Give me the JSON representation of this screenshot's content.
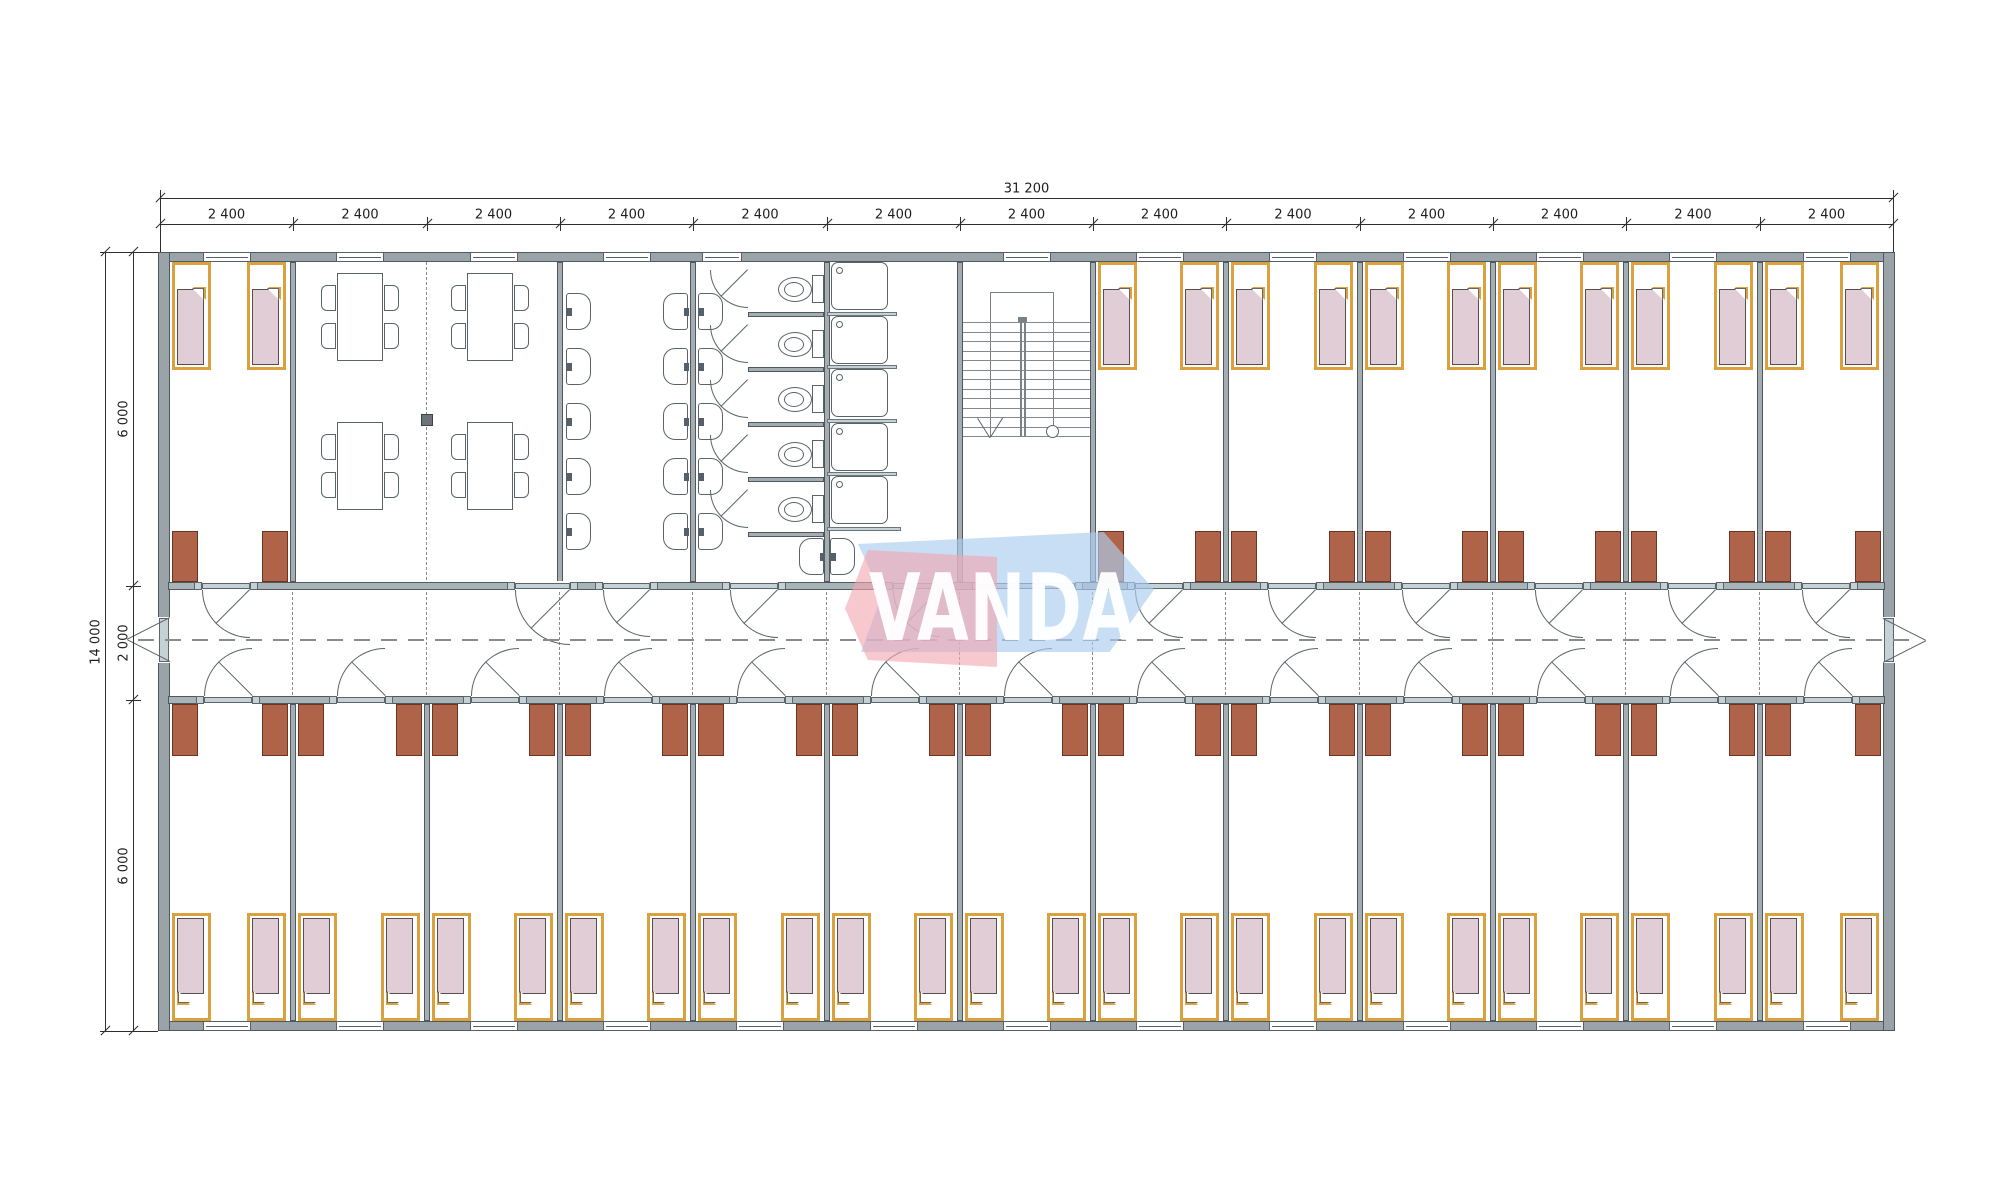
{
  "drawing": {
    "logo": {
      "text": "VANDA",
      "pink": "rgba(242,166,176,0.62)",
      "blue": "rgba(171,205,238,0.66)"
    },
    "dimensions": {
      "top_total_label": "31 200",
      "module_label": "2 400",
      "module_count": 13,
      "left_total_label": "14 000",
      "left_segment_labels": [
        "6 000",
        "2 000",
        "6 000"
      ]
    },
    "colors": {
      "outerWall": "#99a3a8",
      "wallStroke": "#4e585e",
      "innerWall": "#a3adb2",
      "corridorWall": "#a9b4b9",
      "sill": "#c6d1d6",
      "bedFrame": "#dca13f",
      "mattress": "#e0cdd5",
      "wardrobe": "#af6348",
      "wardrobeStroke": "#6f3322",
      "dash": "#8a8a8a",
      "column": "#6e757a"
    },
    "counts": {
      "bedroom_modules_top": [
        0,
        7,
        8,
        9,
        10,
        11,
        12
      ],
      "bedroom_modules_bottom": 13,
      "beds_per_room": 2,
      "wardrobes_per_room": 2,
      "dining_tables": 4,
      "chairs_per_table": 4,
      "basin_columns": 3,
      "basins_per_column": 5,
      "extra_basins": 2,
      "toilet_stalls": 5,
      "shower_trays": 5,
      "stair_treads": 13
    }
  }
}
